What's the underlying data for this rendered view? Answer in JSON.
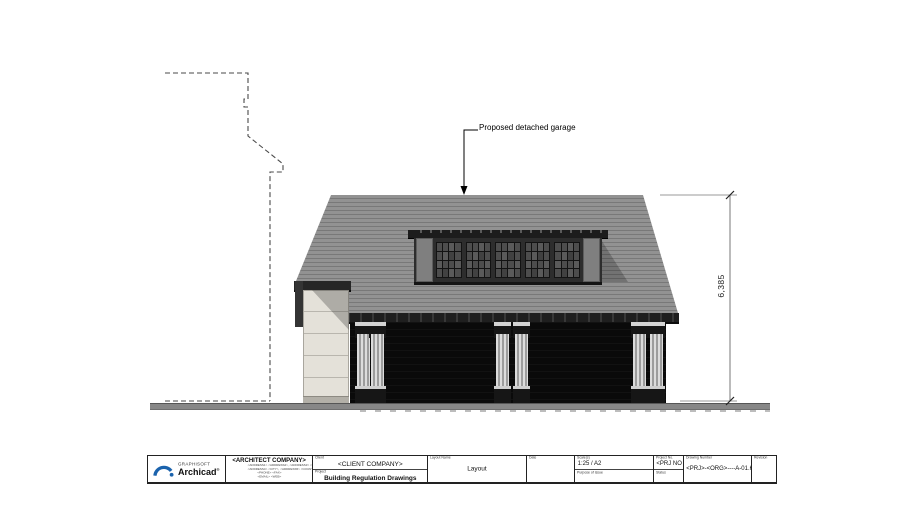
{
  "drawing": {
    "annotation": "Proposed detached garage",
    "dimension_height": "6,385",
    "elements": {
      "roof": "hipped slate roof",
      "dormer": "recessed glazed dormer band, 5 window units",
      "garage_doors": 2,
      "column_pairs": 3,
      "existing_outline": "dashed outline of adjacent building"
    },
    "colors": {
      "roof": "#8a8a8a",
      "dormer_band": "#2d2d2d",
      "garage_door": "#0a0a0a",
      "side_wall": "#e4e1d9",
      "ground": "#878787",
      "linework": "#4a4a4a"
    }
  },
  "title_block": {
    "logo": {
      "brand": "GRAPHISOFT",
      "product": "Archicad",
      "registered": "®"
    },
    "architect": {
      "name": "<ARCHITECT COMPANY>",
      "lines": [
        "<ADDRESS1> <ADDRESS2>, <ADDRESS3> <ZIP>,",
        "<ADDRESS4> <CITY>, <ADDRESS5> <COUNTRY>",
        "<PHONE> <FAX>",
        "<EMAIL> <WEB>"
      ]
    },
    "client_label": "Client",
    "client": "<CLIENT COMPANY>",
    "project_label": "Project",
    "project": "Building Regulation Drawings",
    "layout_label": "Layout Name",
    "layout": "Layout",
    "date_label": "Date",
    "date": "",
    "scale_label": "Scale(s)",
    "scale": "1:25 / A2",
    "purpose_label": "Purpose of issue",
    "project_no_label": "Project No.",
    "project_no": "<PRJ NO",
    "status_label": "Status",
    "drawing_no_label": "Drawing Number",
    "drawing_no": "<PRJ>-<ORG>----A-01.6",
    "revision_label": "Revision",
    "revision": ""
  }
}
